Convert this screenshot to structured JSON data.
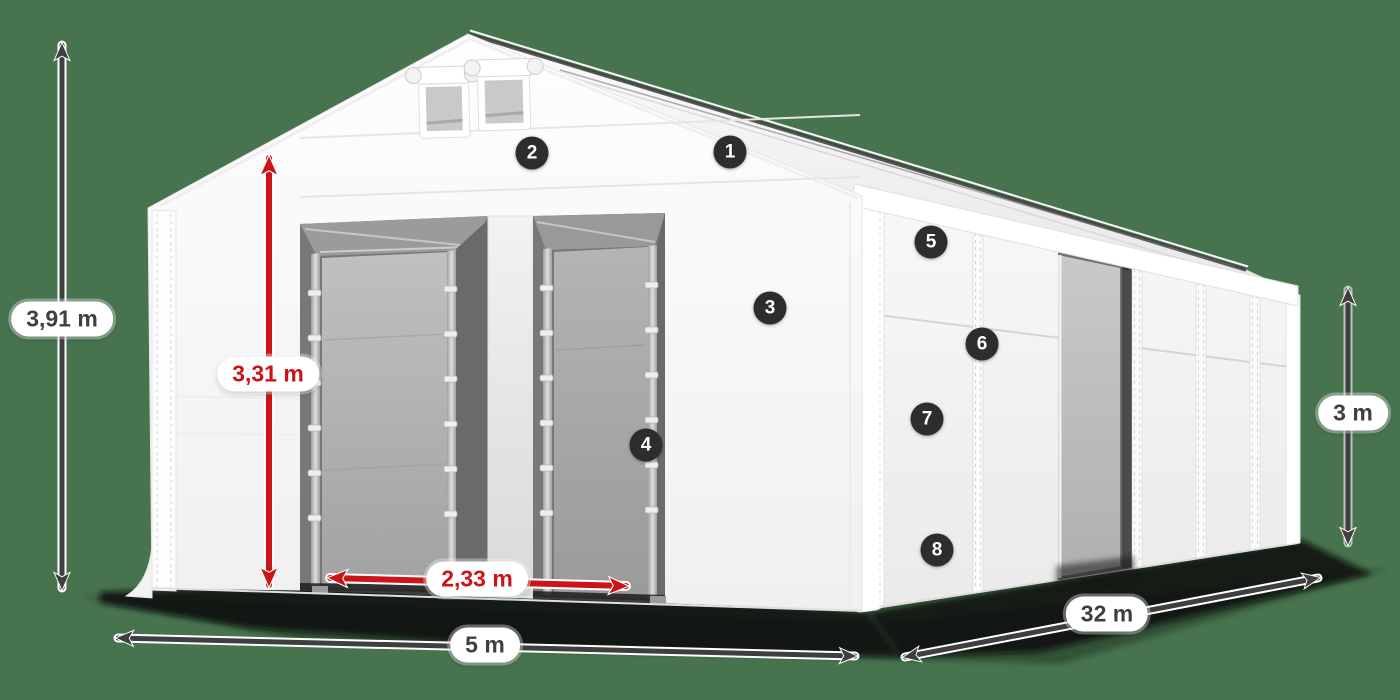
{
  "diagram": {
    "dimension_labels": {
      "total_height": "3,91 m",
      "entrance_height": "3,31 m",
      "entrance_width": "2,33 m",
      "front_width": "5 m",
      "side_length": "32 m",
      "side_wall_height": "3 m"
    },
    "feature_badges": [
      "1",
      "2",
      "3",
      "4",
      "5",
      "6",
      "7",
      "8"
    ],
    "colors": {
      "background": "#47734E",
      "dimension_red": "#CB1417",
      "dimension_dark": "#3F3F3F",
      "badge_background": "#2D2D2D",
      "badge_text": "#FFFFFF",
      "label_pill_background": "#FFFFFF",
      "tent_white": "#F7F7F7",
      "door_panel_gray": "#ADADAD"
    }
  }
}
